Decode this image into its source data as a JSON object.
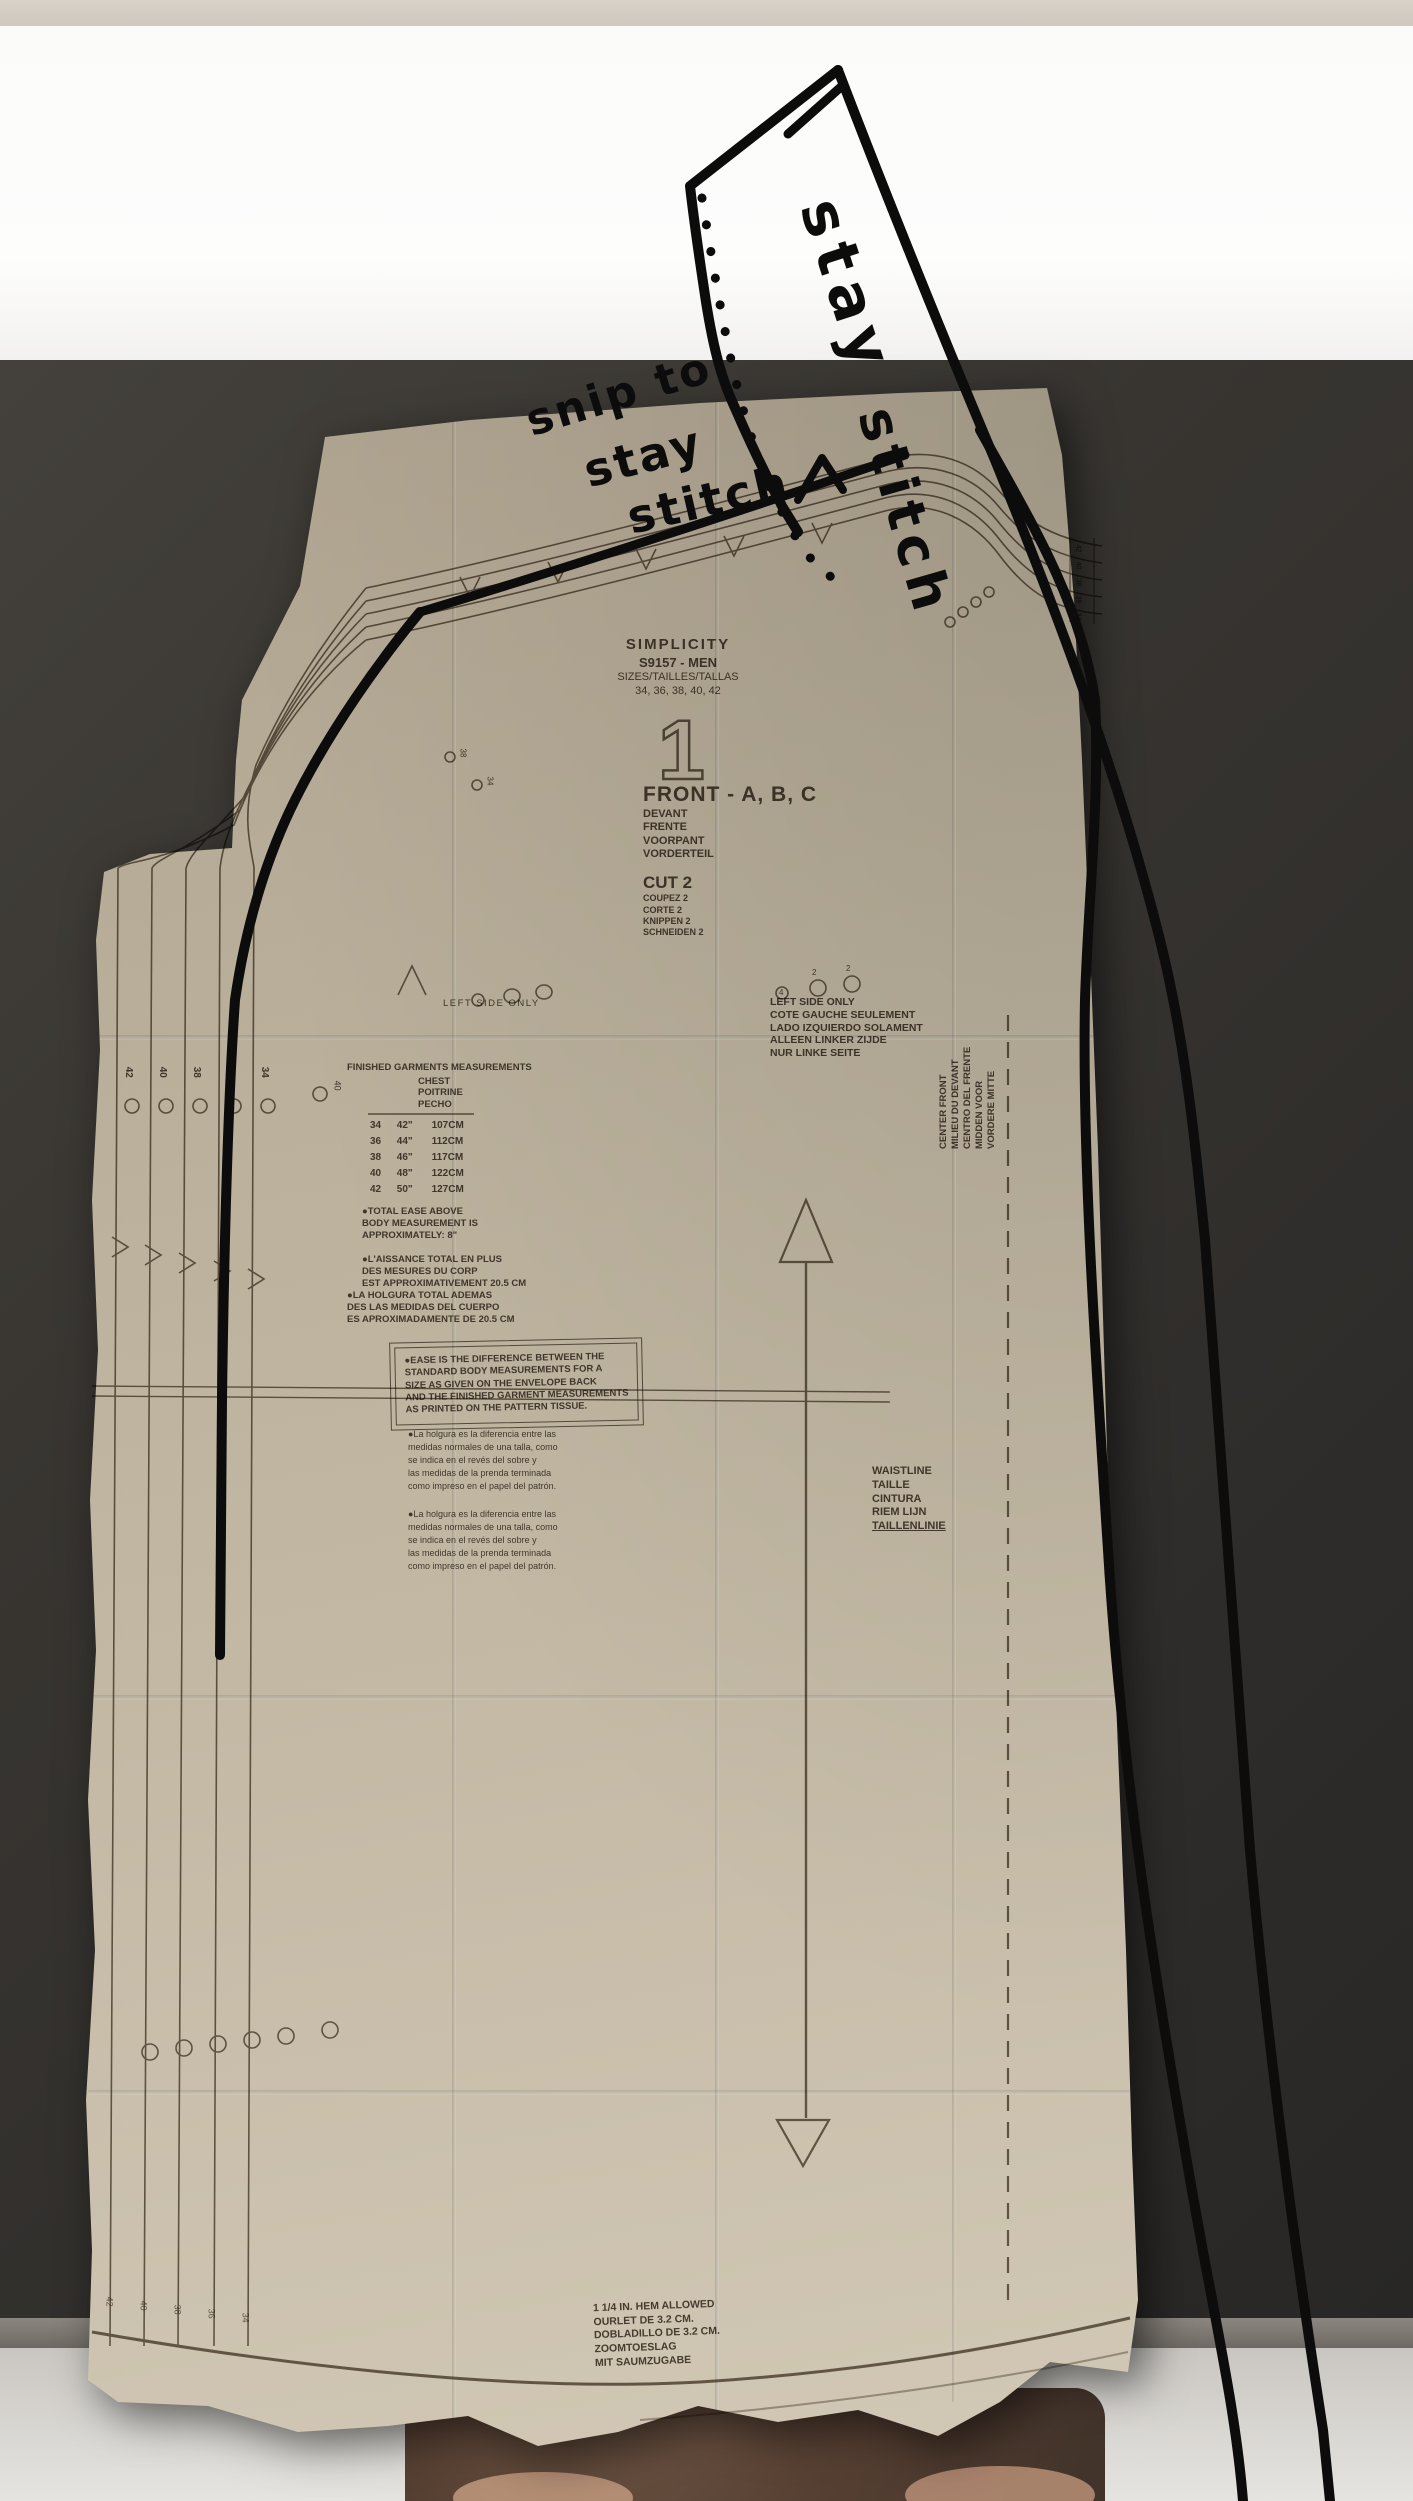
{
  "colors": {
    "paper": "#bfb4a0",
    "print": "#3f3429",
    "marker": "#0c0c0c",
    "wall": "#353230"
  },
  "pattern": {
    "brand": "SIMPLICITY",
    "style_number": "S9157 - MEN",
    "sizes_label": "SIZES/TAILLES/TALLAS",
    "sizes": "34, 36, 38, 40, 42",
    "piece_number": "1",
    "piece_title": "FRONT - A, B, C",
    "piece_title_langs": [
      "DEVANT",
      "FRENTE",
      "VOORPANT",
      "VORDERTEIL"
    ],
    "cut_label": "CUT 2",
    "cut_langs": [
      "COUPEZ 2",
      "CORTE 2",
      "KNIPPEN 2",
      "SCHNEIDEN 2"
    ],
    "left_side_note": "LEFT SIDE ONLY",
    "left_side_block": [
      "LEFT SIDE ONLY",
      "COTE GAUCHE SEULEMENT",
      "LADO IZQUIERDO SOLAMENT",
      "ALLEEN LINKER ZIJDE",
      "NUR LINKE SEITE"
    ],
    "finished_title": "FINISHED GARMENTS MEASUREMENTS",
    "chest_header": [
      "CHEST",
      "POITRINE",
      "PECHO"
    ],
    "size_table": [
      [
        "34",
        "42\"",
        "107CM"
      ],
      [
        "36",
        "44\"",
        "112CM"
      ],
      [
        "38",
        "46\"",
        "117CM"
      ],
      [
        "40",
        "48\"",
        "122CM"
      ],
      [
        "42",
        "50\"",
        "127CM"
      ]
    ],
    "ease_en": [
      "●TOTAL EASE ABOVE",
      "BODY MEASUREMENT IS",
      "APPROXIMATELY: 8\""
    ],
    "ease_fr": [
      "●L'AISSANCE TOTAL EN PLUS",
      "DES MESURES DU CORP",
      "EST APPROXIMATIVEMENT 20.5 CM"
    ],
    "ease_es": [
      "●LA HOLGURA TOTAL ADEMAS",
      "DES LAS MEDIDAS DEL CUERPO",
      "ES APROXIMADAMENTE DE 20.5 CM"
    ],
    "ease_box": [
      "●EASE IS THE DIFFERENCE BETWEEN THE",
      "STANDARD BODY MEASUREMENTS FOR A",
      "SIZE AS GIVEN ON THE ENVELOPE BACK",
      "AND THE FINISHED GARMENT MEASUREMENTS",
      "AS PRINTED ON THE PATTERN TISSUE."
    ],
    "ease_small_1": [
      "●La holgura es la diferencia entre las",
      "medidas normales de una talla, como",
      "se indica en el revés del sobre y",
      "las medidas de la prenda terminada",
      "como impreso en el papel del patrón."
    ],
    "ease_small_2": [
      "●La holgura es la diferencia entre las",
      "medidas normales de una talla, como",
      "se indica en el revés del sobre y",
      "las medidas de la prenda terminada",
      "como impreso en el papel del patrón."
    ],
    "waistline": [
      "WAISTLINE",
      "TAILLE",
      "CINTURA",
      "RIEM LIJN",
      "TAILLENLINIE"
    ],
    "center_front": [
      "CENTER FRONT",
      "MILIEU DU DEVANT",
      "CENTRO DEL FRENTE",
      "MIDDEN VOOR",
      "VORDERE MITTE"
    ],
    "hem": [
      "1 1/4 IN. HEM ALLOWED",
      "OURLET DE 3.2 CM.",
      "DOBLADILLO DE 3.2 CM.",
      "ZOOMTOESLAG",
      "MIT SAUMZUGABE"
    ],
    "size_run": [
      "42",
      "40",
      "38",
      "36",
      "34"
    ],
    "notch_sizes": [
      "38",
      "34"
    ],
    "grain_extra_size": "40",
    "button_circle_number": "4",
    "button_small_number": "2"
  },
  "annotations": {
    "flag_word1": "stay",
    "flag_word2": "stitch",
    "snip_line1": "snip to",
    "snip_line2": "stay",
    "snip_line3": "stitch"
  }
}
